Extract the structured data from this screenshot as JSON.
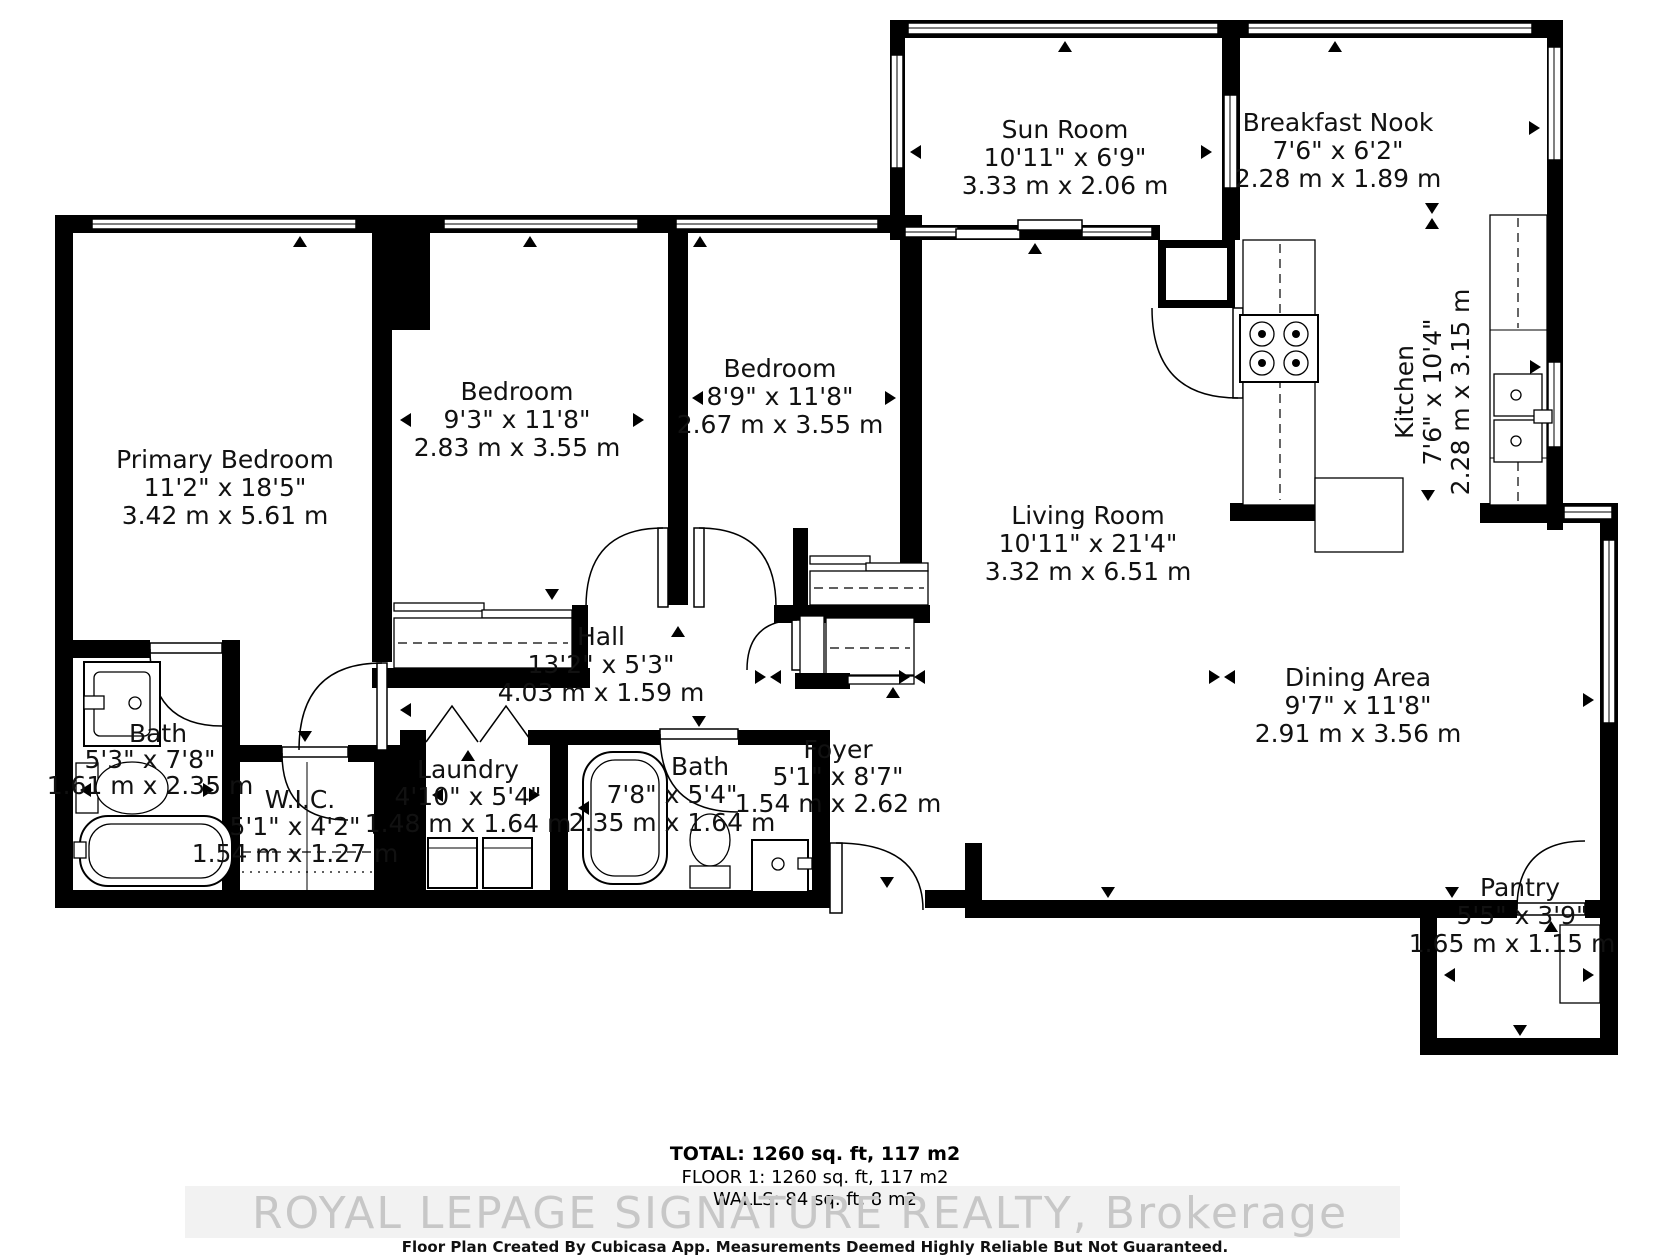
{
  "rooms": [
    {
      "name": "Sun Room",
      "imperial": "10'11\" x 6'9\"",
      "metric": "3.33 m x 2.06 m"
    },
    {
      "name": "Breakfast Nook",
      "imperial": "7'6\" x 6'2\"",
      "metric": "2.28 m x 1.89 m"
    },
    {
      "name": "Kitchen",
      "imperial": "7'6\" x 10'4\"",
      "metric": "2.28 m x 3.15 m"
    },
    {
      "name": "Primary Bedroom",
      "imperial": "11'2\" x 18'5\"",
      "metric": "3.42 m x 5.61 m"
    },
    {
      "name": "Bedroom",
      "imperial": "9'3\" x 11'8\"",
      "metric": "2.83 m x 3.55 m"
    },
    {
      "name": "Bedroom",
      "imperial": "8'9\" x 11'8\"",
      "metric": "2.67 m x 3.55 m"
    },
    {
      "name": "Living Room",
      "imperial": "10'11\" x 21'4\"",
      "metric": "3.32 m x 6.51 m"
    },
    {
      "name": "Dining Area",
      "imperial": "9'7\" x 11'8\"",
      "metric": "2.91 m x 3.56 m"
    },
    {
      "name": "Hall",
      "imperial": "13'2\" x 5'3\"",
      "metric": "4.03 m x 1.59 m"
    },
    {
      "name": "Bath",
      "imperial": "5'3\" x 7'8\"",
      "metric": "1.61 m x 2.35 m"
    },
    {
      "name": "W.I.C.",
      "imperial": "5'1\" x 4'2\"",
      "metric": "1.54 m x 1.27 m"
    },
    {
      "name": "Laundry",
      "imperial": "4'10\" x 5'4\"",
      "metric": "1.48 m x 1.64 m"
    },
    {
      "name": "Bath",
      "imperial": "7'8\" x 5'4\"",
      "metric": "2.35 m x 1.64 m"
    },
    {
      "name": "Foyer",
      "imperial": "5'1\" x 8'7\"",
      "metric": "1.54 m x 2.62 m"
    },
    {
      "name": "Pantry",
      "imperial": "5'5\" x 3'9\"",
      "metric": "1.65 m x 1.15 m"
    }
  ],
  "footer": {
    "total": "TOTAL: 1260 sq. ft, 117 m2",
    "floor": "FLOOR 1: 1260 sq. ft, 117 m2",
    "walls": "WALLS: 84 sq. ft, 8 m2"
  },
  "watermark": "ROYAL LEPAGE SIGNATURE REALTY, Brokerage",
  "disclaimer": "Floor Plan Created By Cubicasa App. Measurements Deemed Highly Reliable But Not Guaranteed.",
  "colors": {
    "wall": "#000000",
    "background": "#ffffff",
    "watermark": "#c7c7c7"
  }
}
